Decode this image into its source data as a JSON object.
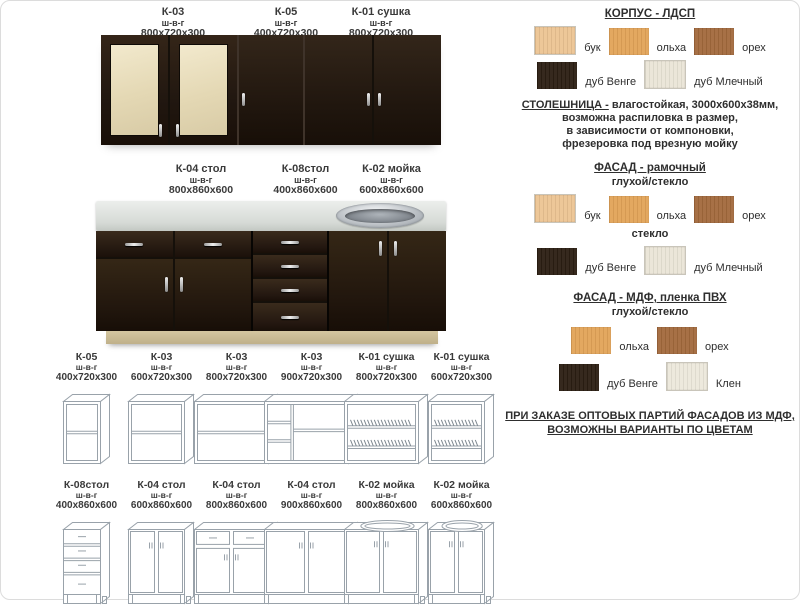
{
  "catalog": {
    "dims_label": "ш-в-г",
    "upper_photo": {
      "items": [
        {
          "code": "К-03",
          "dims": "800х720х300"
        },
        {
          "code": "К-05",
          "dims": "400х720х300"
        },
        {
          "code": "К-01 сушка",
          "dims": "800х720х300"
        }
      ]
    },
    "base_photo": {
      "items": [
        {
          "code": "К-04 стол",
          "dims": "800х860х600"
        },
        {
          "code": "К-08стол",
          "dims": "400х860х600"
        },
        {
          "code": "К-02 мойка",
          "dims": "600х860х600"
        }
      ]
    },
    "wire_rows": [
      [
        {
          "code": "К-05",
          "dims": "400х720х300",
          "drawing": "shelf-box"
        },
        {
          "code": "К-03",
          "dims": "600х720х300",
          "drawing": "shelf-box"
        },
        {
          "code": "К-03",
          "dims": "800х720х300",
          "drawing": "shelf-box"
        },
        {
          "code": "К-03",
          "dims": "900х720х300",
          "drawing": "divided-box"
        },
        {
          "code": "К-01 сушка",
          "dims": "800х720х300",
          "drawing": "dish-rack"
        },
        {
          "code": "К-01 сушка",
          "dims": "600х720х300",
          "drawing": "dish-rack"
        }
      ],
      [
        {
          "code": "К-08стол",
          "dims": "400х860х600",
          "drawing": "drawer-stack"
        },
        {
          "code": "К-04 стол",
          "dims": "600х860х600",
          "drawing": "double-doors"
        },
        {
          "code": "К-04 стол",
          "dims": "800х860х600",
          "drawing": "drawers-doors"
        },
        {
          "code": "К-04 стол",
          "dims": "900х860х600",
          "drawing": "double-doors"
        },
        {
          "code": "К-02 мойка",
          "dims": "800х860х600",
          "drawing": "sink-doors"
        },
        {
          "code": "К-02 мойка",
          "dims": "600х860х600",
          "drawing": "sink-doors"
        }
      ]
    ]
  },
  "materials": {
    "korpus": {
      "title": "КОРПУС - ЛДСП",
      "rows": [
        [
          {
            "label": "бук",
            "color": "#ecc493"
          },
          {
            "label": "ольха",
            "color": "#e2a358"
          },
          {
            "label": "орех",
            "color": "#a2693c"
          }
        ],
        [
          {
            "label": "дуб Венге",
            "color": "#2b1e12"
          },
          {
            "label": "дуб Млечный",
            "color": "#eae5d7"
          }
        ]
      ]
    },
    "countertop": {
      "title": "СТОЛЕШНИЦА -",
      "line1_rest": " влагостойкая, 3000х600х38мм,",
      "lines": [
        "возможна распиловка в размер,",
        "в зависимости от компоновки,",
        "фрезеровка под врезную мойку"
      ]
    },
    "fasad_frame": {
      "title": "ФАСАД - рамочный",
      "subtitle": "глухой/стекло",
      "glass_label": "стекло",
      "rows": [
        [
          {
            "label": "бук",
            "color": "#ecc493"
          },
          {
            "label": "ольха",
            "color": "#e2a358"
          },
          {
            "label": "орех",
            "color": "#a2693c"
          }
        ],
        [
          {
            "label": "дуб Венге",
            "color": "#2b1e12"
          },
          {
            "label": "дуб Млечный",
            "color": "#eae5d7"
          }
        ]
      ]
    },
    "fasad_mdf": {
      "title": "ФАСАД - МДФ, пленка ПВХ",
      "subtitle": "глухой/стекло",
      "rows": [
        [
          {
            "label": "ольха",
            "color": "#e2a358"
          },
          {
            "label": "орех",
            "color": "#a2693c"
          }
        ],
        [
          {
            "label": "дуб Венге",
            "color": "#2b1e12"
          },
          {
            "label": "Клен",
            "color": "#ece8db"
          }
        ]
      ]
    },
    "note_lines": [
      "ПРИ ЗАКАЗЕ ОПТОВЫХ ПАРТИЙ ФАСАДОВ ИЗ МДФ,",
      "ВОЗМОЖНЫ ВАРИАНТЫ ПО ЦВЕТАМ"
    ]
  }
}
